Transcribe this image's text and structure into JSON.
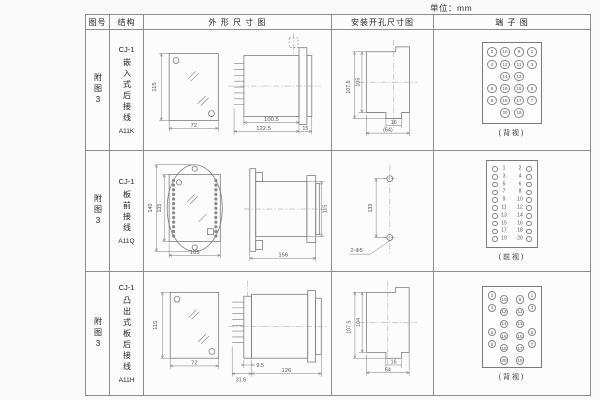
{
  "unit_label": "单位：mm",
  "header": {
    "figure": "图号",
    "structure": "结构",
    "outline": "外 形 尺 寸 图",
    "mounting": "安装开孔尺寸图",
    "terminal": "端 子 图"
  },
  "rows": [
    {
      "figure": "附图3",
      "model": "CJ-1",
      "mount_type": "嵌入式后接线",
      "code": "A11K",
      "outline": {
        "height": "115",
        "width": "72",
        "body_len": "100.5",
        "total_len": "122.5",
        "flange": "15"
      },
      "mounting": {
        "outer_h": "107.5",
        "inner_h": "105",
        "slot_w": "16",
        "total_w": "(64)"
      },
      "terminal": {
        "style": "back-grid",
        "caption": "(背视)",
        "grid": [
          [
            "2",
            "10",
            "9",
            "1"
          ],
          [
            "4",
            "12",
            "11",
            "3"
          ],
          [
            "",
            "14",
            "13",
            ""
          ],
          [
            "6",
            "16",
            "15",
            "5"
          ],
          [
            "8",
            "18",
            "17",
            "7"
          ],
          [
            "",
            "20",
            "19",
            ""
          ]
        ]
      }
    },
    {
      "figure": "附图3",
      "model": "CJ-1",
      "mount_type": "板前接线",
      "code": "A11Q",
      "outline": {
        "height": "140",
        "inner_h": "135",
        "width": "105",
        "body_len": "156",
        "body_h": "115"
      },
      "mounting": {
        "hole_span": "133",
        "hole_label": "2-Φ5"
      },
      "terminal": {
        "style": "front-cols",
        "caption": "(前视)",
        "left": [
          "1",
          "3",
          "5",
          "7",
          "9",
          "11",
          "13",
          "15",
          "17",
          "19"
        ],
        "right": [
          "2",
          "4",
          "6",
          "8",
          "10",
          "12",
          "14",
          "16",
          "18",
          "20"
        ]
      }
    },
    {
      "figure": "附图3",
      "model": "CJ-1",
      "mount_type": "凸出式板后接线",
      "code": "A11H",
      "outline": {
        "height": "115",
        "width": "72",
        "pin_len": "9.5",
        "base_len": "31.5",
        "body_len": "126"
      },
      "mounting": {
        "outer_h": "107.5",
        "inner_h": "104",
        "slot_w": "16",
        "total_w": "64"
      },
      "terminal": {
        "style": "back-stagger",
        "caption": "(背视)",
        "grid": [
          [
            "2",
            "10",
            "9",
            "1"
          ],
          [
            "4",
            "12",
            "11",
            "3"
          ],
          [
            "",
            "14",
            "13",
            ""
          ],
          [
            "6",
            "16",
            "15",
            "5"
          ],
          [
            "8",
            "18",
            "17",
            "7"
          ],
          [
            "",
            "20",
            "19",
            ""
          ]
        ]
      }
    }
  ]
}
